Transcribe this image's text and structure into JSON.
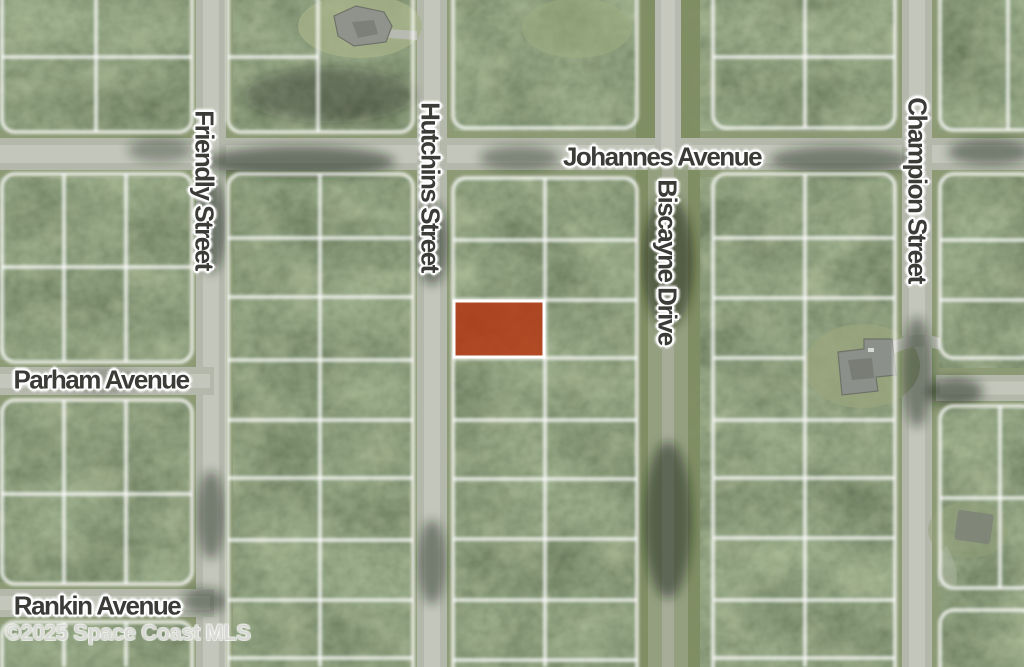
{
  "map": {
    "description": "Aerial satellite parcel map with highlighted vacant lot",
    "watermark": "©2025 Space Coast MLS",
    "streets": {
      "johannes": {
        "label": "Johannes Avenue",
        "orientation": "horizontal"
      },
      "friendly": {
        "label": "Friendly Street",
        "orientation": "vertical"
      },
      "hutchins": {
        "label": "Hutchins Street",
        "orientation": "vertical"
      },
      "biscayne": {
        "label": "Biscayne Drive",
        "orientation": "vertical"
      },
      "champion": {
        "label": "Champion Street",
        "orientation": "vertical"
      },
      "parham": {
        "label": "Parham Avenue",
        "orientation": "horizontal"
      },
      "rankin": {
        "label": "Rankin Avenue",
        "orientation": "horizontal"
      }
    },
    "highlight_parcel": {
      "fill": "#b5330f",
      "fill_opacity": 0.82,
      "stroke": "#ffffff",
      "x": 454,
      "y": 301,
      "width": 90,
      "height": 56
    },
    "palette": {
      "vegetation": "#3f4a33",
      "road": "#b4b8ab",
      "road_center": "#c3c6ba",
      "verge": "#8d9a74",
      "parcel_line": "#ffffff",
      "label_text": "#3b3b38",
      "label_halo": "#ffffff"
    }
  }
}
